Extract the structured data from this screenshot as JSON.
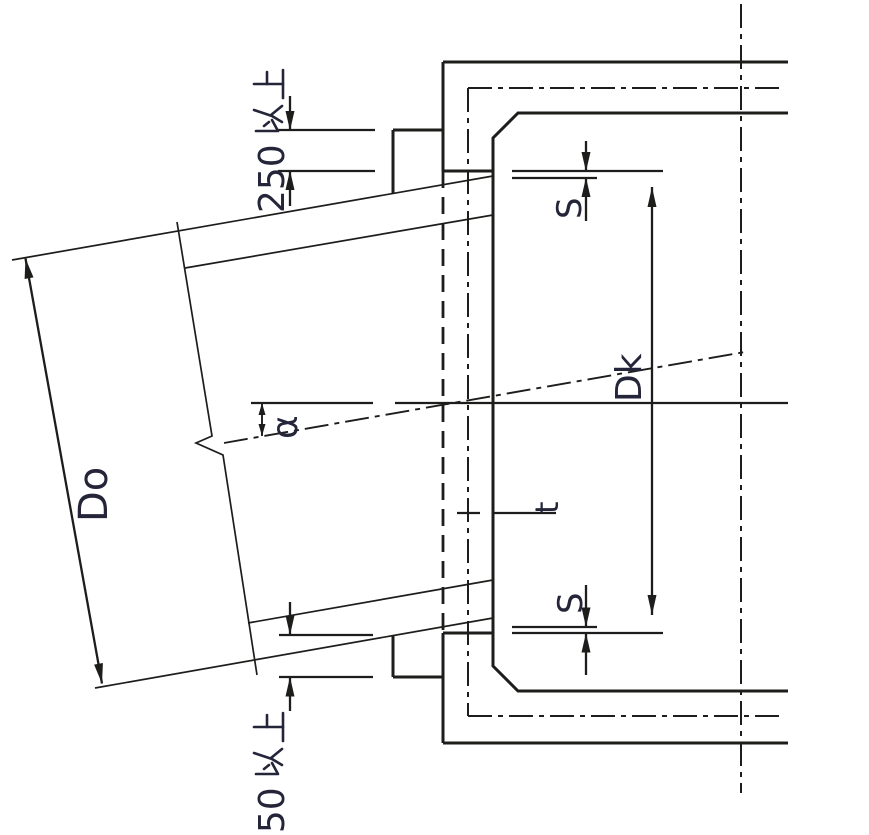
{
  "drawing": {
    "type": "pipe-to-manhole connection detail",
    "labels": {
      "embed_top": "250以上",
      "embed_top_digits": "250",
      "embed_bottom": "250以上",
      "embed_bottom_digits": "250",
      "pipe_outer_diameter": "Do",
      "core_hole_diameter": "Dk",
      "clearance_top": "S",
      "clearance_bottom": "S",
      "connection_angle": "α",
      "wall_thickness": "t"
    },
    "colors": {
      "line": "#1d1d1b",
      "text": "#25253a",
      "background": "#ffffff"
    }
  }
}
